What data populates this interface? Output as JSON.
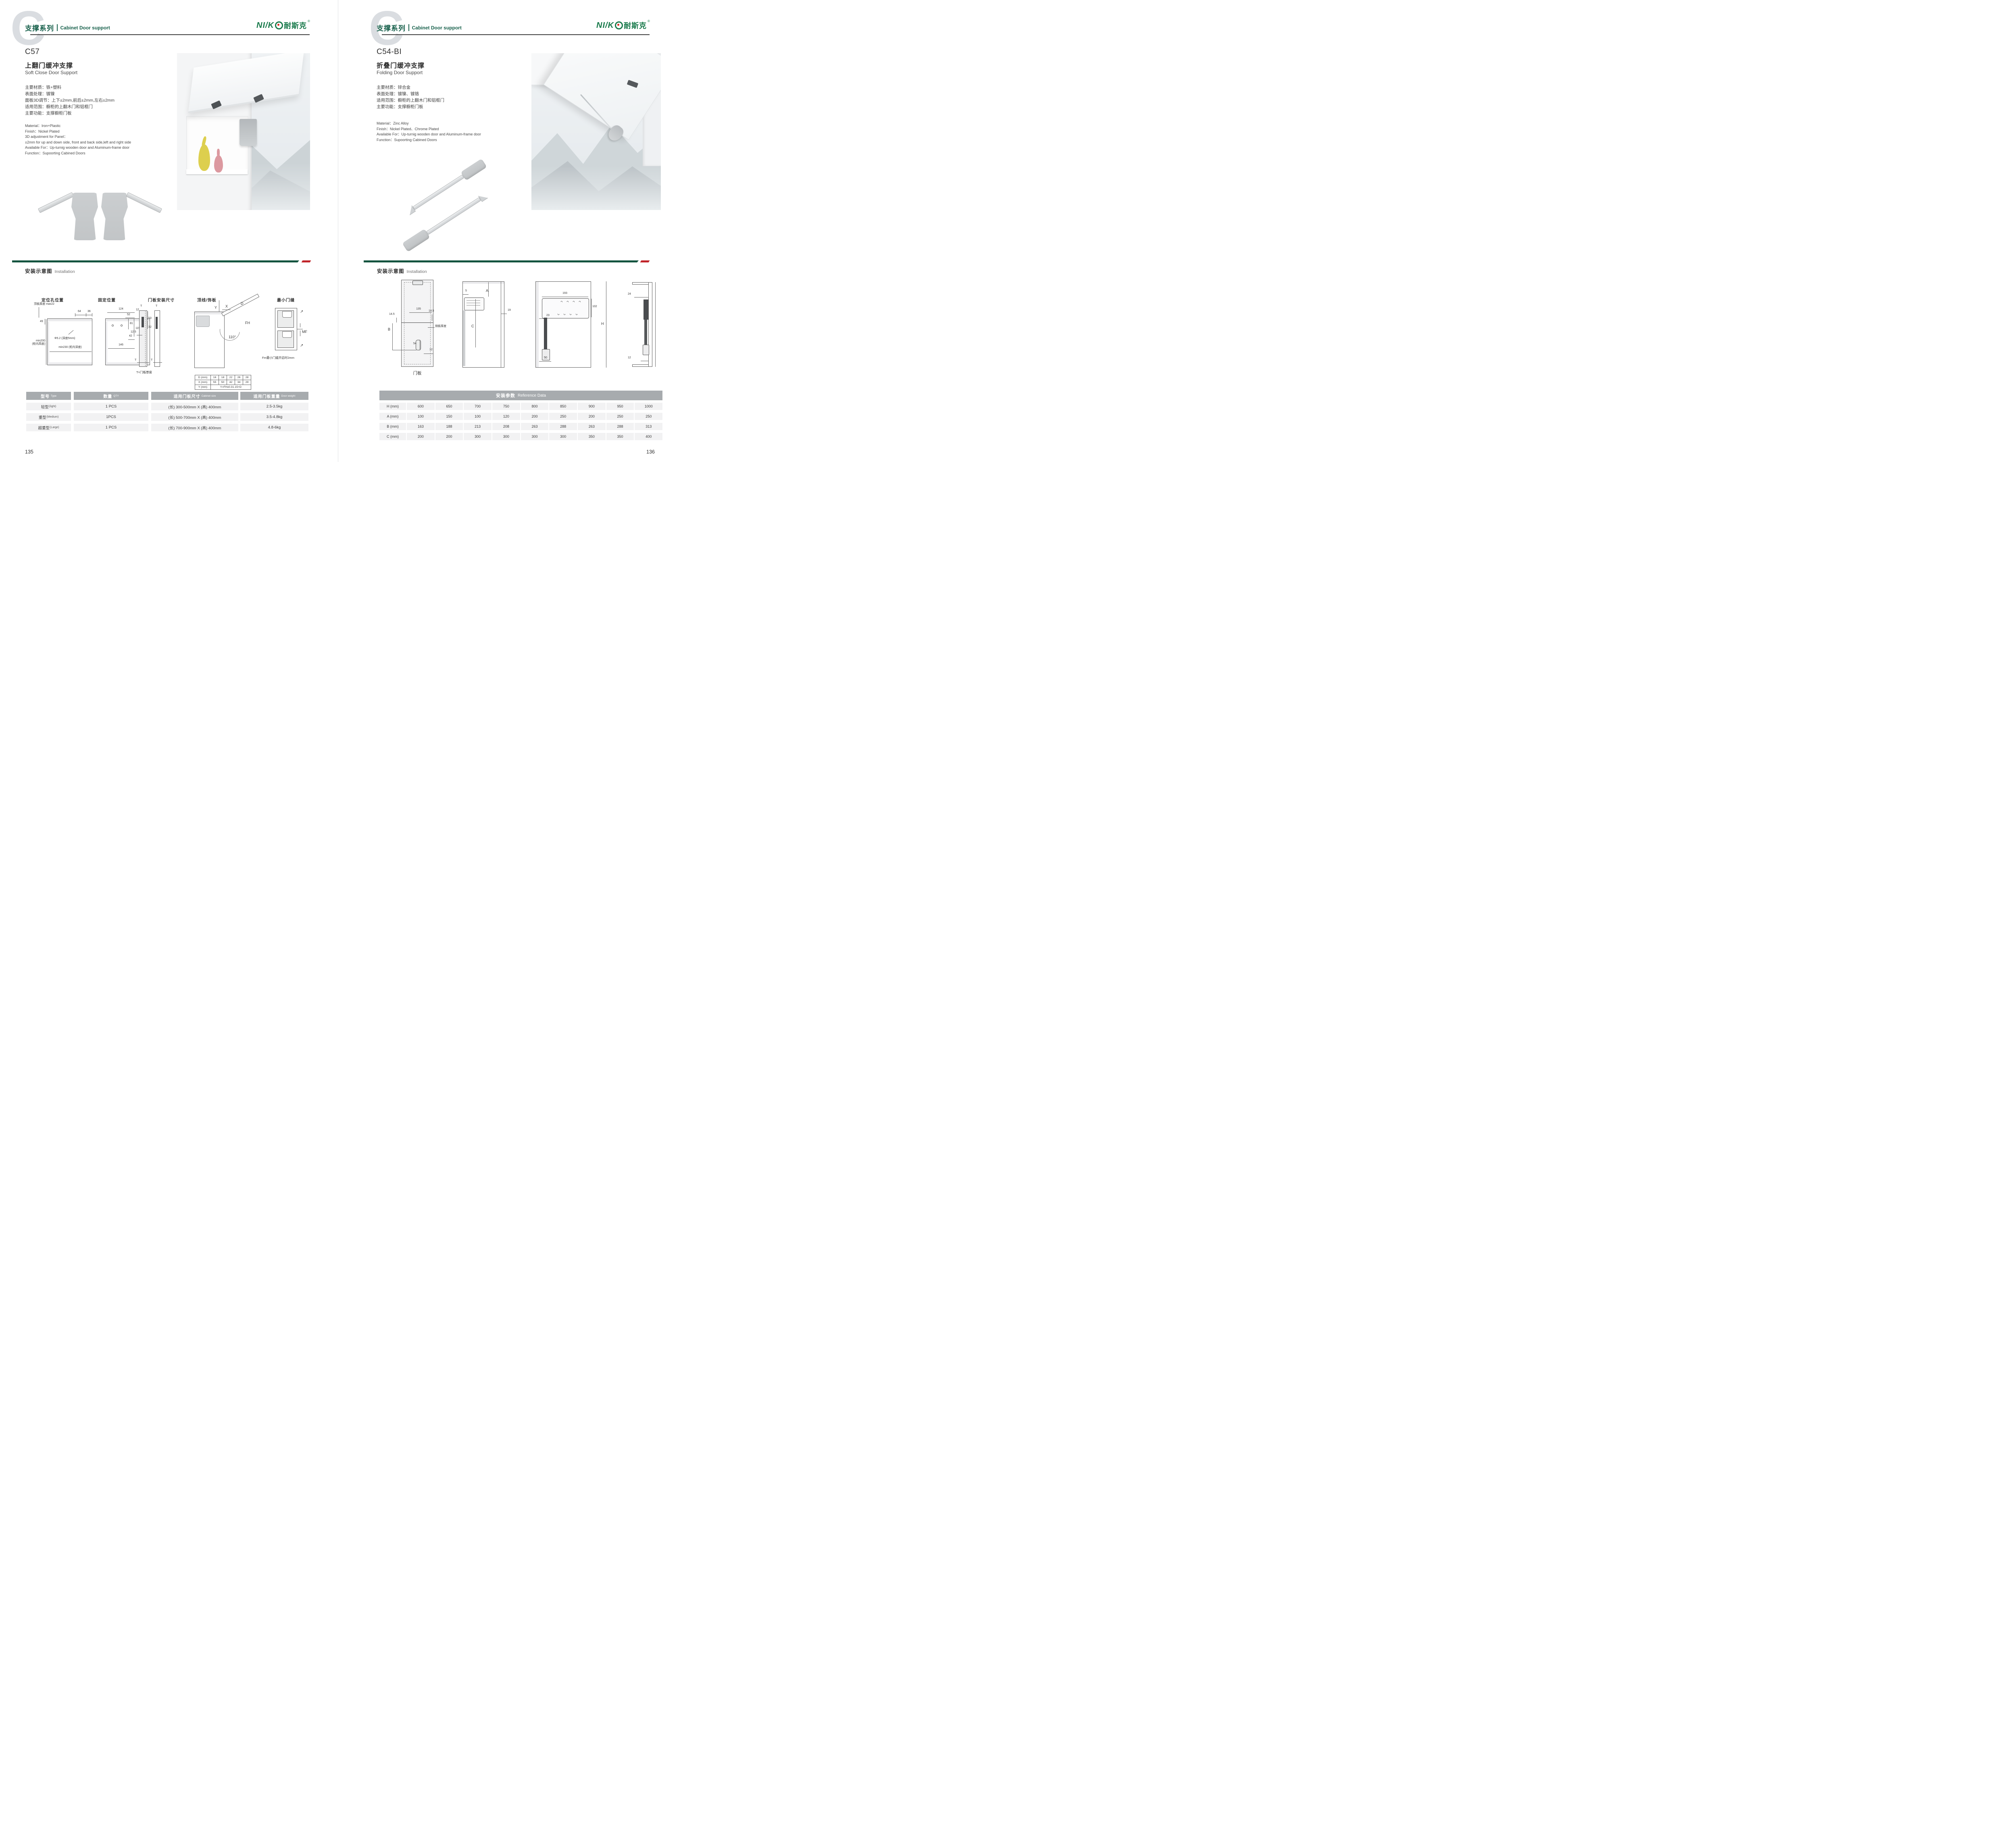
{
  "brand": {
    "latin": "NI/K",
    "cn": "耐斯克",
    "reg": "®"
  },
  "left": {
    "watermark": "C",
    "series_cn": "支撑系列",
    "series_en": "Cabinet Door support",
    "model": "C57",
    "title_cn": "上翻门缓冲支撑",
    "title_en": "Soft Close Door Support",
    "specs_cn": [
      "主要材质：铁+塑料",
      "表面处理：镀镍",
      "面板3D调节：上下±2mm,前后±2mm,左右±2mm",
      "适用范围：橱柜的上翻木门和铝框门",
      "主要功能：支撑橱柜门板"
    ],
    "specs_en": [
      "Material：Iron+Plastic",
      "Finish：Nickel Plated",
      "3D adjustment for Panel：",
      "±2mm for up and down side, front and back side,left and right side",
      "Available For：Up-turnig wooden door and Aluminum-frame door",
      "Function：Supoorting Cabined Doors"
    ],
    "install_cn": "安装示意图",
    "install_en": "Installation",
    "diag_titles": [
      "定位孔位置",
      "固定位置",
      "门板安装尺寸",
      "顶线/饰板",
      "最小门缝"
    ],
    "d1": {
      "top": "顶板厚度 max22",
      "a": "49",
      "b": "64",
      "c": "36",
      "hole": "Φ5.2 (深度5mm)",
      "h1": "min200",
      "h2": "(柜内高度)",
      "depth": "min230 (柜内深度)"
    },
    "d2": {
      "a": "124",
      "b": "52",
      "c": "12",
      "d": "81",
      "e": "115",
      "f": "42",
      "g": "146"
    },
    "d3": {
      "t1": "T",
      "t2": "T",
      "a": "53",
      "b": "32",
      "c": "12.5",
      "t3": "T",
      "t4": "T",
      "note": "T=门板厚度"
    },
    "d4": {
      "y": "Y",
      "x": "X",
      "d": "D",
      "fh": "FH",
      "ang": "110°"
    },
    "mini": [
      [
        "D (mm)",
        "16",
        "18",
        "22",
        "26",
        "28"
      ],
      [
        "X (mm)",
        "55",
        "50",
        "42",
        "34",
        "29"
      ],
      [
        "Y (mm)",
        "Y=FHx0.31-15+D"
      ]
    ],
    "d5": {
      "mf": "MF",
      "note": "Fm最小门缝开启时2mm"
    },
    "table": {
      "headers": [
        {
          "c": "型号",
          "e": "Type"
        },
        {
          "c": "数量",
          "e": "QTY"
        },
        {
          "c": "适用门板尺寸",
          "e": "Cabinet size"
        },
        {
          "c": "适用门板重量",
          "e": "Door weight"
        }
      ],
      "rows": [
        [
          "轻型",
          "(light)",
          "1 PCS",
          "(长) 300-500mm X (高) 400mm",
          "2.5-3.5kg"
        ],
        [
          "重型",
          "(Medium)",
          "1PCS",
          "(长) 500-700mm X (高) 400mm",
          "3.5-4.8kg"
        ],
        [
          "超重型",
          "(Large)",
          "1 PCS",
          "(长) 700-900mm X (高) 400mm",
          "4.8-6kg"
        ]
      ]
    },
    "page_no": "135"
  },
  "right": {
    "watermark": "C",
    "series_cn": "支撑系列",
    "series_en": "Cabinet Door support",
    "model": "C54-BI",
    "title_cn": "折叠门缓冲支撑",
    "title_en": "Folding Door Support",
    "specs_cn": [
      "主要材质：锌合金",
      "表面处理：镀镍、镀铬",
      "适用范围：橱柜的上翻木门和铝框门",
      "主要功能：支撑橱柜门板"
    ],
    "specs_en": [
      "Material：Zinc Alloy",
      "Finish：Nickel Plated、Chrome Plated",
      "Available For：Up-turnig wooden door and Aluminum-frame door",
      "Function：Supoorting Cabined Doors"
    ],
    "install_cn": "安装示意图",
    "install_en": "Installation",
    "d1": {
      "a": "135",
      "b": "14.5",
      "c": "14.5",
      "bb": "B",
      "d": "54",
      "e": "12",
      "side": "侧板厚度",
      "cap": "门板"
    },
    "d2": {
      "a": "5",
      "b": "A",
      "c": "C",
      "d": "19"
    },
    "d3": {
      "a": "193",
      "b": "102",
      "c": "23",
      "d": "50",
      "h": "H"
    },
    "d4": {
      "a": "24",
      "b": "12"
    },
    "table": {
      "title_cn": "安装参数",
      "title_en": "Reference Data",
      "rows": [
        [
          "H (mm)",
          "600",
          "650",
          "700",
          "750",
          "800",
          "850",
          "900",
          "950",
          "1000"
        ],
        [
          "A (mm)",
          "100",
          "150",
          "100",
          "120",
          "200",
          "250",
          "200",
          "250",
          "250"
        ],
        [
          "B (mm)",
          "163",
          "188",
          "213",
          "208",
          "263",
          "288",
          "263",
          "288",
          "313"
        ],
        [
          "C (mm)",
          "200",
          "200",
          "300",
          "300",
          "300",
          "300",
          "350",
          "350",
          "400"
        ]
      ]
    },
    "page_no": "136"
  }
}
